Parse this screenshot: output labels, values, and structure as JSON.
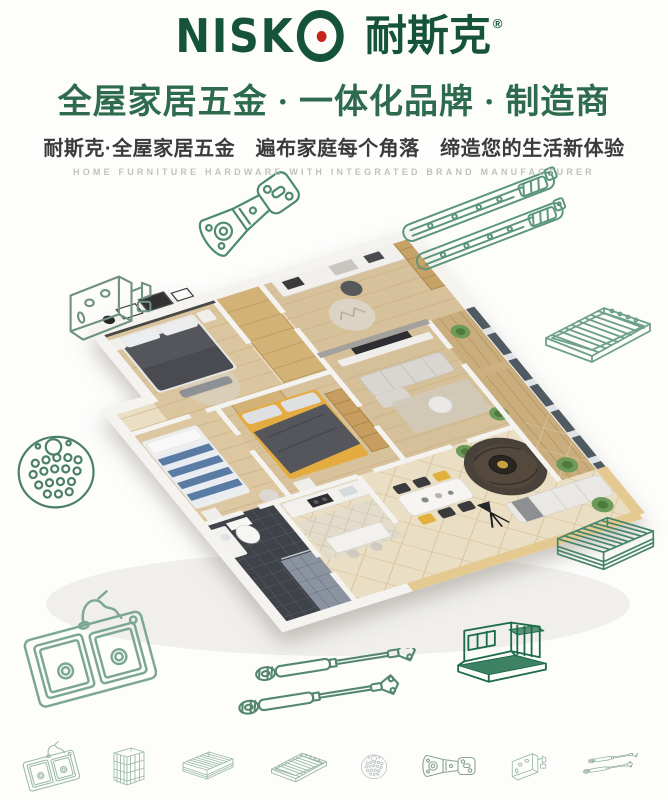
{
  "brand": {
    "latin_prefix": "NISK",
    "latin_o": "O",
    "cn": "耐斯克",
    "registered": "®",
    "colors": {
      "logo_green": "#15543a",
      "logo_dot_red": "#c2271c"
    }
  },
  "header": {
    "headline": "全屋家居五金 · 一体化品牌 · 制造商",
    "subheadline": "耐斯克·全屋家居五金　遍布家庭每个角落　缔造您的生活新体验",
    "english_tagline": "HOME FURNITURE HARDWARE WITH INTEGRATED BRAND MANUFACTURER",
    "colors": {
      "headline": "#2e6b4e",
      "subheadline": "#3b3b3b",
      "english": "#c2c1bf"
    }
  },
  "illustrations": {
    "hero": {
      "name": "isometric-apartment-cutaway-render"
    },
    "line_art_palette": {
      "light_green": "#5b967c",
      "dark_green": "#1d6b49"
    },
    "scatter": [
      {
        "name": "hinge-illustration-top-left",
        "icon": "cabinet-hinge",
        "x": 188,
        "y": 182,
        "w": 120,
        "rot": -35,
        "color": "#4d8a6e"
      },
      {
        "name": "drawer-slide-illustration-1",
        "icon": "drawer-slide",
        "x": 396,
        "y": 192,
        "w": 172,
        "rot": -21,
        "color": "#5b967c"
      },
      {
        "name": "drawer-slide-illustration-2",
        "icon": "drawer-slide",
        "x": 410,
        "y": 222,
        "w": 166,
        "rot": -21,
        "color": "#5b967c"
      },
      {
        "name": "bracket-illustration-left",
        "icon": "corner-bracket",
        "x": 58,
        "y": 268,
        "w": 105,
        "rot": 0,
        "color": "#6e9180"
      },
      {
        "name": "perforated-plate-illustration-left",
        "icon": "perforated-plate",
        "x": 12,
        "y": 428,
        "w": 88,
        "rot": -6,
        "color": "#4c8066"
      },
      {
        "name": "wire-shelf-illustration-right",
        "icon": "wire-shelf",
        "x": 538,
        "y": 298,
        "w": 120,
        "rot": 0,
        "color": "#6fa08a"
      },
      {
        "name": "drawer-basket-illustration-right",
        "icon": "drawer-basket",
        "x": 548,
        "y": 512,
        "w": 115,
        "rot": 0,
        "color": "#48856a"
      },
      {
        "name": "sink-illustration-bottom-left",
        "icon": "double-sink",
        "x": 22,
        "y": 588,
        "w": 135,
        "rot": 0,
        "color": "#7ca795"
      },
      {
        "name": "gas-struts-illustration-bottom",
        "icon": "gas-struts",
        "x": 230,
        "y": 648,
        "w": 210,
        "rot": 0,
        "color": "#55876f"
      },
      {
        "name": "wire-rack-illustration-bottom-right",
        "icon": "wire-rack",
        "x": 450,
        "y": 596,
        "w": 102,
        "rot": 0,
        "color": "#1d6b49"
      }
    ],
    "footer_icons": [
      {
        "icon": "double-sink",
        "w": 58,
        "color": "#9db9ab"
      },
      {
        "icon": "pull-out-basket",
        "w": 40,
        "color": "#9db9ab"
      },
      {
        "icon": "drawer-basket",
        "w": 60,
        "color": "#9db9ab"
      },
      {
        "icon": "wire-shelf",
        "w": 64,
        "color": "#9db9ab"
      },
      {
        "icon": "perforated-plate",
        "w": 30,
        "color": "#b6bdb9"
      },
      {
        "icon": "cabinet-hinge",
        "w": 60,
        "color": "#8aa294"
      },
      {
        "icon": "corner-bracket",
        "w": 44,
        "color": "#9db9ab"
      },
      {
        "icon": "gas-struts",
        "w": 66,
        "color": "#86a893"
      }
    ]
  },
  "apartment_palette": {
    "wood_floor": "#d9c39c",
    "cream_tile": "#eadfc4",
    "wardrobe_tan": "#d3b277",
    "feature_wall_charcoal": "#4a4846",
    "bed_dark_gray": "#54575c",
    "bed_yellow": "#e3ab3f",
    "kids_bed_blue": "#5a7ca4",
    "bath_tile_dark": "#3f434a",
    "wall_white": "#f4f3f0",
    "bottom_wall_tan": "#e4ca90",
    "plant_green": "#6d9a58"
  }
}
